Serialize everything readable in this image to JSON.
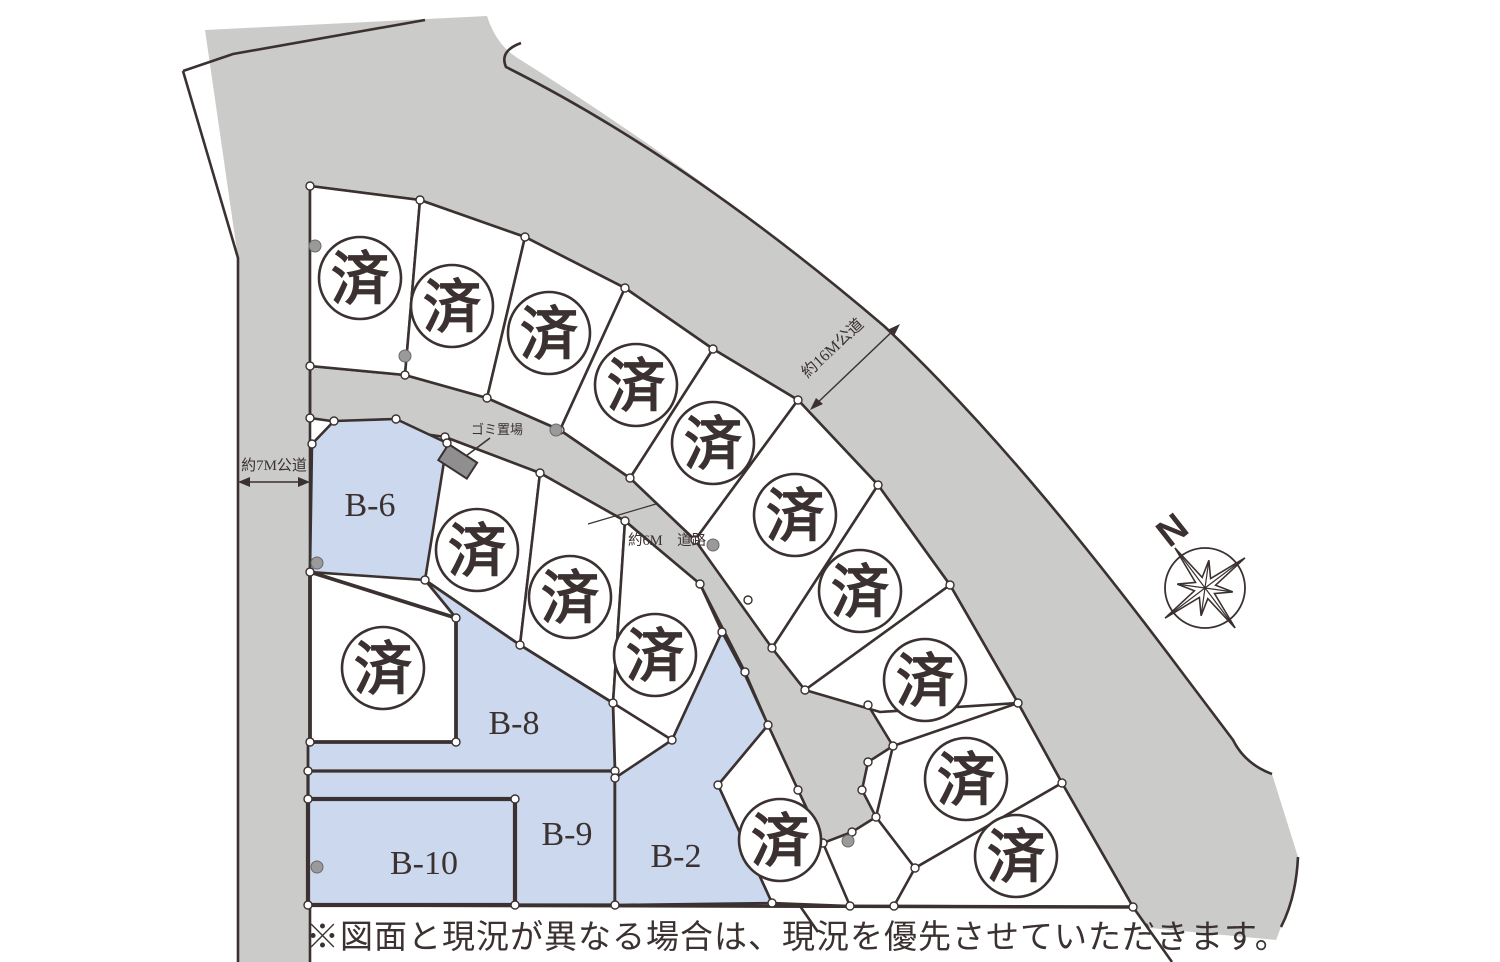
{
  "map": {
    "colors": {
      "road": "#cbcbca",
      "available_fill": "#ccd8ed",
      "sold_fill": "#ffffff",
      "line": "#3a3130",
      "garbage_fill": "#8f8f8f"
    },
    "roads": [
      {
        "id": "road-7m",
        "label": "約7M公道"
      },
      {
        "id": "road-16m",
        "label": "約16M公道"
      },
      {
        "id": "road-6m",
        "label": "約6M　道路"
      }
    ],
    "facilities": {
      "garbage_label": "ゴミ置場"
    },
    "compass": {
      "label": "N"
    },
    "lots": {
      "sold_label": "済",
      "sold_count": 15,
      "available": [
        {
          "label": "B-6"
        },
        {
          "label": "B-8"
        },
        {
          "label": "B-9"
        },
        {
          "label": "B-10"
        },
        {
          "label": "B-2"
        }
      ]
    }
  },
  "footer": {
    "note": "※図面と現況が異なる場合は、現況を優先させていただきます。"
  }
}
